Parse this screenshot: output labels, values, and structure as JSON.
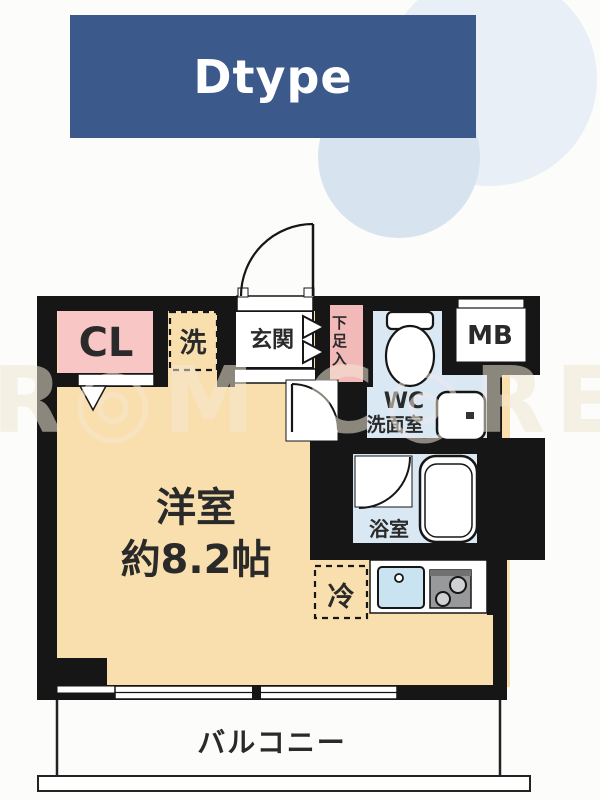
{
  "title": {
    "label": "Dtype",
    "bg_color": "#3c598b",
    "text_color": "#ffffff"
  },
  "watermark": {
    "text": "R◎M C◎RE"
  },
  "plan": {
    "wall_color": "#161616",
    "floor_color": "#f8dfad",
    "wet_area_color": "#d9e8f2",
    "rooms": {
      "closet": {
        "label": "CL",
        "color": "#f8c6c4"
      },
      "washer": {
        "label": "洗"
      },
      "entrance": {
        "label": "玄関"
      },
      "shoe_box": {
        "label": "下足入",
        "color": "#f2b9b9"
      },
      "wc": {
        "label_line1": "WC",
        "label_line2": "洗面室"
      },
      "meter_box": {
        "label": "MB"
      },
      "bathroom": {
        "label": "浴室"
      },
      "fridge": {
        "label": "冷"
      },
      "main_room": {
        "label_line1": "洋室",
        "label_line2": "約8.2帖"
      },
      "balcony": {
        "label": "バルコニー"
      }
    }
  }
}
